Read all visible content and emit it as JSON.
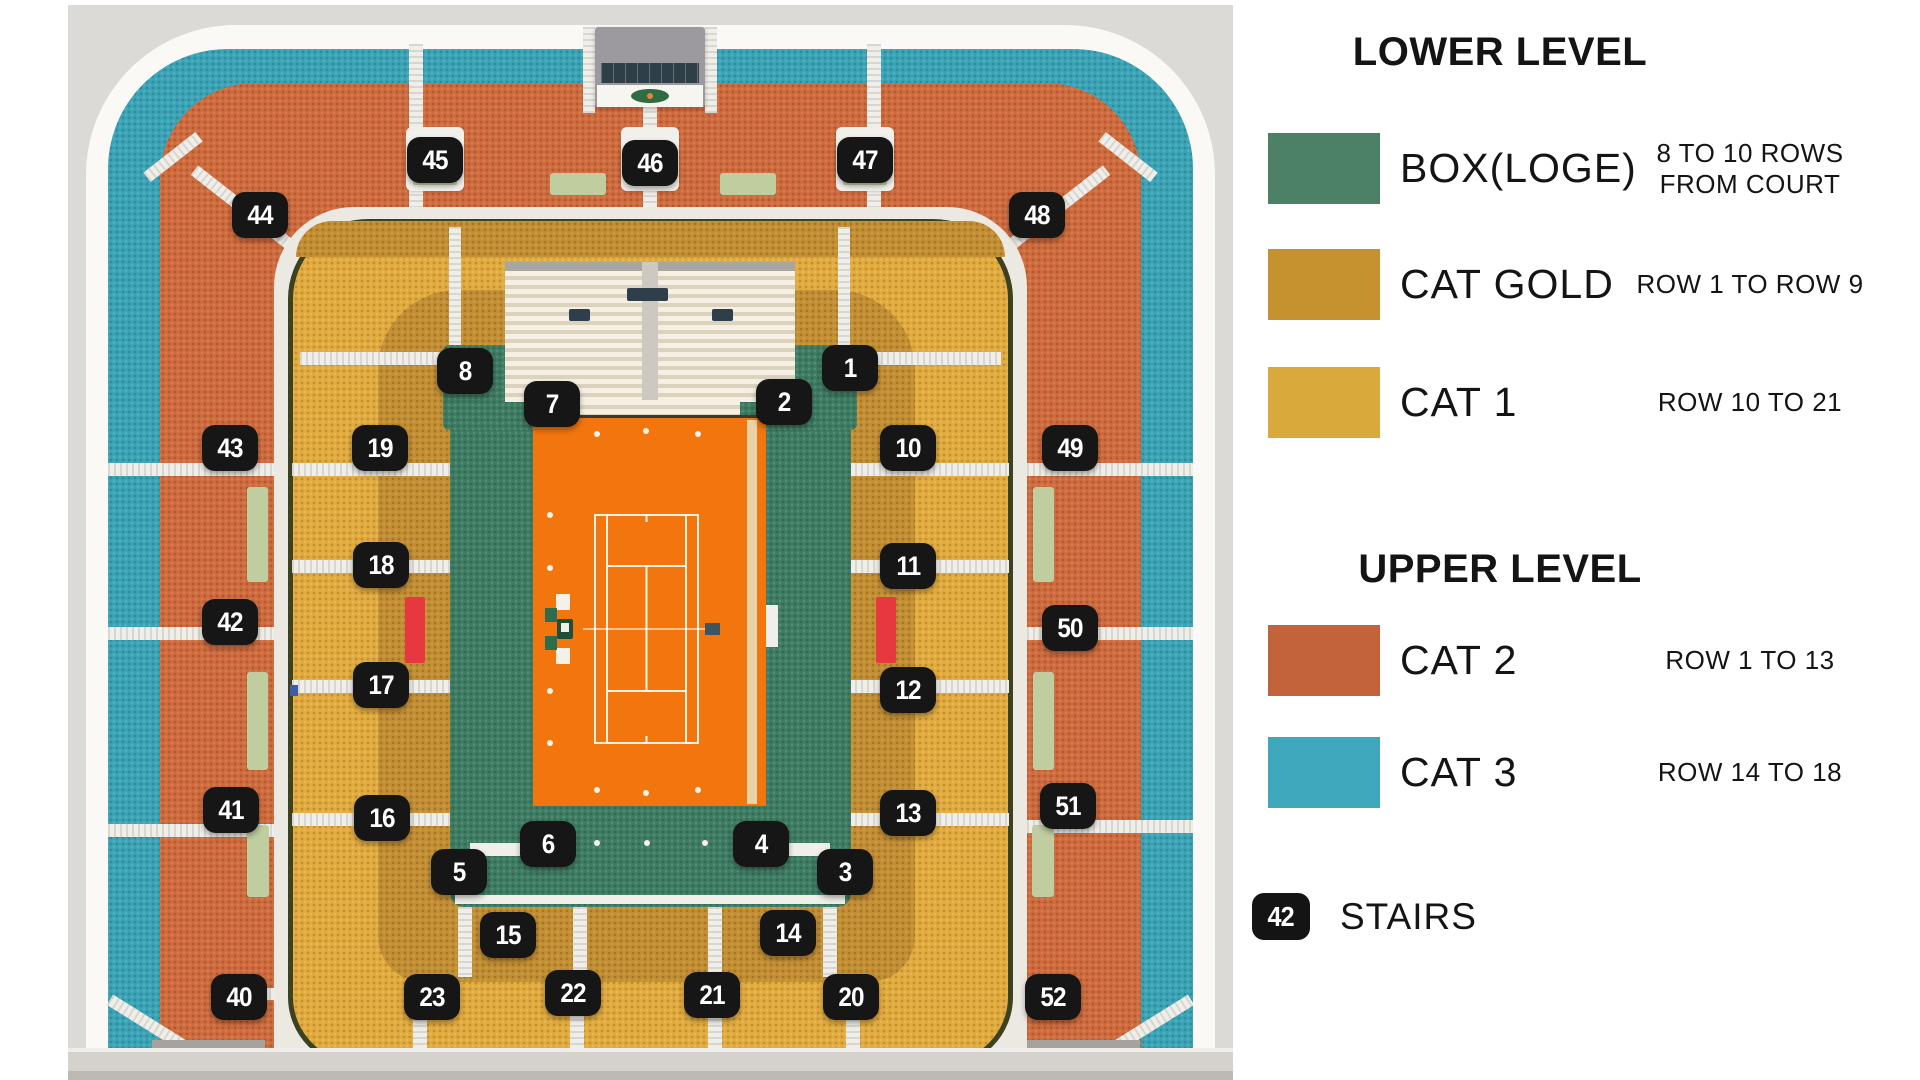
{
  "legend": {
    "lower": {
      "title": "LOWER LEVEL",
      "rows": [
        {
          "label": "BOX(LOGE)",
          "desc1": "8 TO 10 ROWS",
          "desc2": "FROM COURT",
          "color": "#4C8168"
        },
        {
          "label": "CAT GOLD",
          "desc1": "ROW 1 TO ROW 9",
          "desc2": "",
          "color": "#C6912F"
        },
        {
          "label": "CAT 1",
          "desc1": "ROW 10 TO 21",
          "desc2": "",
          "color": "#D9A93C"
        }
      ]
    },
    "upper": {
      "title": "UPPER LEVEL",
      "rows": [
        {
          "label": "CAT 2",
          "desc1": "ROW 1 TO 13",
          "desc2": "",
          "color": "#C2633C"
        },
        {
          "label": "CAT 3",
          "desc1": "ROW 14 TO 18",
          "desc2": "",
          "color": "#3FA8BC"
        }
      ]
    },
    "stairs": {
      "badge": "42",
      "label": "STAIRS",
      "color": "#141414"
    }
  },
  "map": {
    "court_color": "#F2750E",
    "band_colors": {
      "cat3": "#3AA4B6",
      "cat2": "#CF6B3D",
      "cat1": "#E2AB3E",
      "cat_gold": "#C38E32",
      "box": "#3E7C63"
    },
    "badge_color": "#161616",
    "sections": [
      "1",
      "2",
      "3",
      "4",
      "5",
      "6",
      "7",
      "8",
      "10",
      "11",
      "12",
      "13",
      "14",
      "15",
      "16",
      "17",
      "18",
      "19",
      "20",
      "21",
      "22",
      "23",
      "40",
      "41",
      "42",
      "43",
      "44",
      "45",
      "46",
      "47",
      "48",
      "49",
      "50",
      "51",
      "52"
    ]
  }
}
